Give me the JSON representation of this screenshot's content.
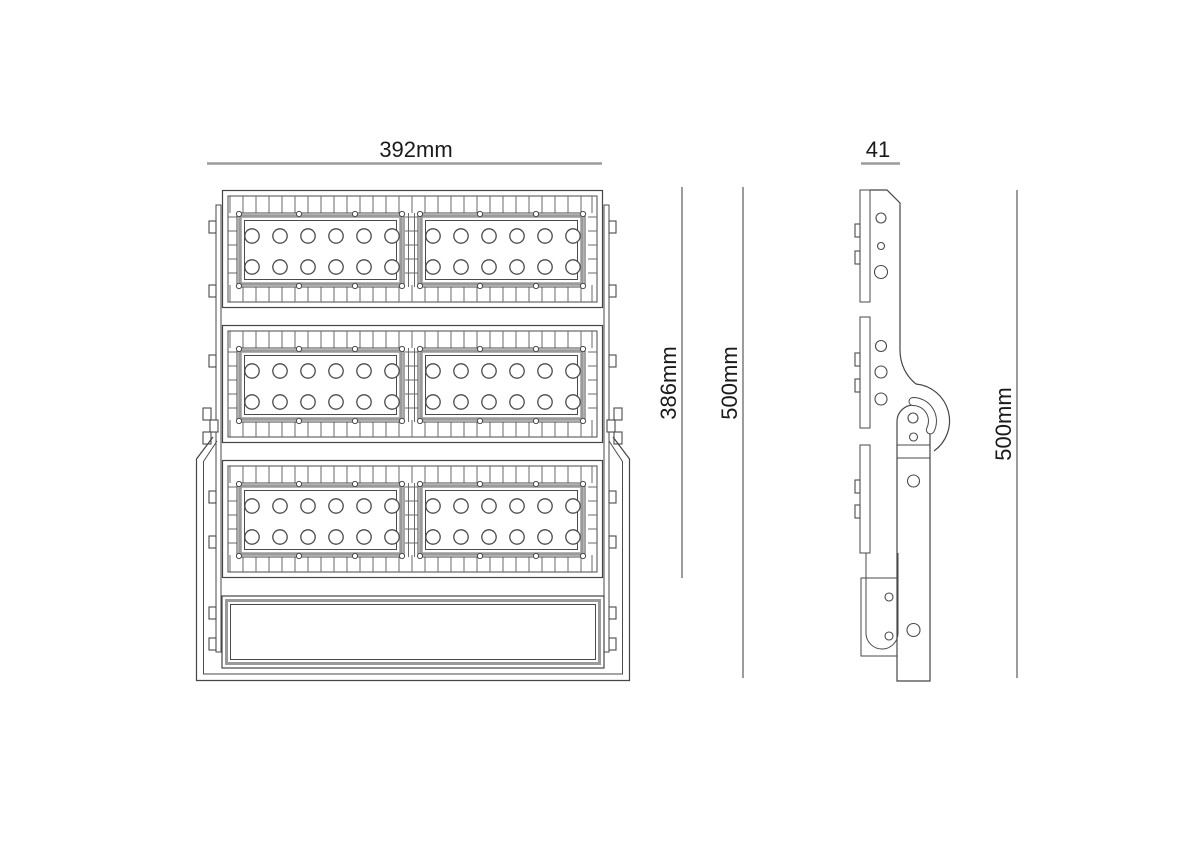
{
  "drawing": {
    "kind": "technical dimension drawing",
    "subject": "LED floodlight, front and side elevation views"
  },
  "dimensions": {
    "front_width_label": "392mm",
    "led_section_height_label": "386mm",
    "front_total_height_label": "500mm",
    "side_width_label": "41",
    "side_height_label": "500mm"
  },
  "figure": {
    "module_rows": 3,
    "panels_per_module": 2,
    "led_columns_per_panel": 6,
    "led_rows_per_panel": 2,
    "leds_per_panel": 12
  },
  "colors": {
    "background": "#ffffff",
    "line": "#454545",
    "panel_frame": "#9a9a9a",
    "dimension_line": "#9b9b9b",
    "text": "#1a1a1a"
  }
}
